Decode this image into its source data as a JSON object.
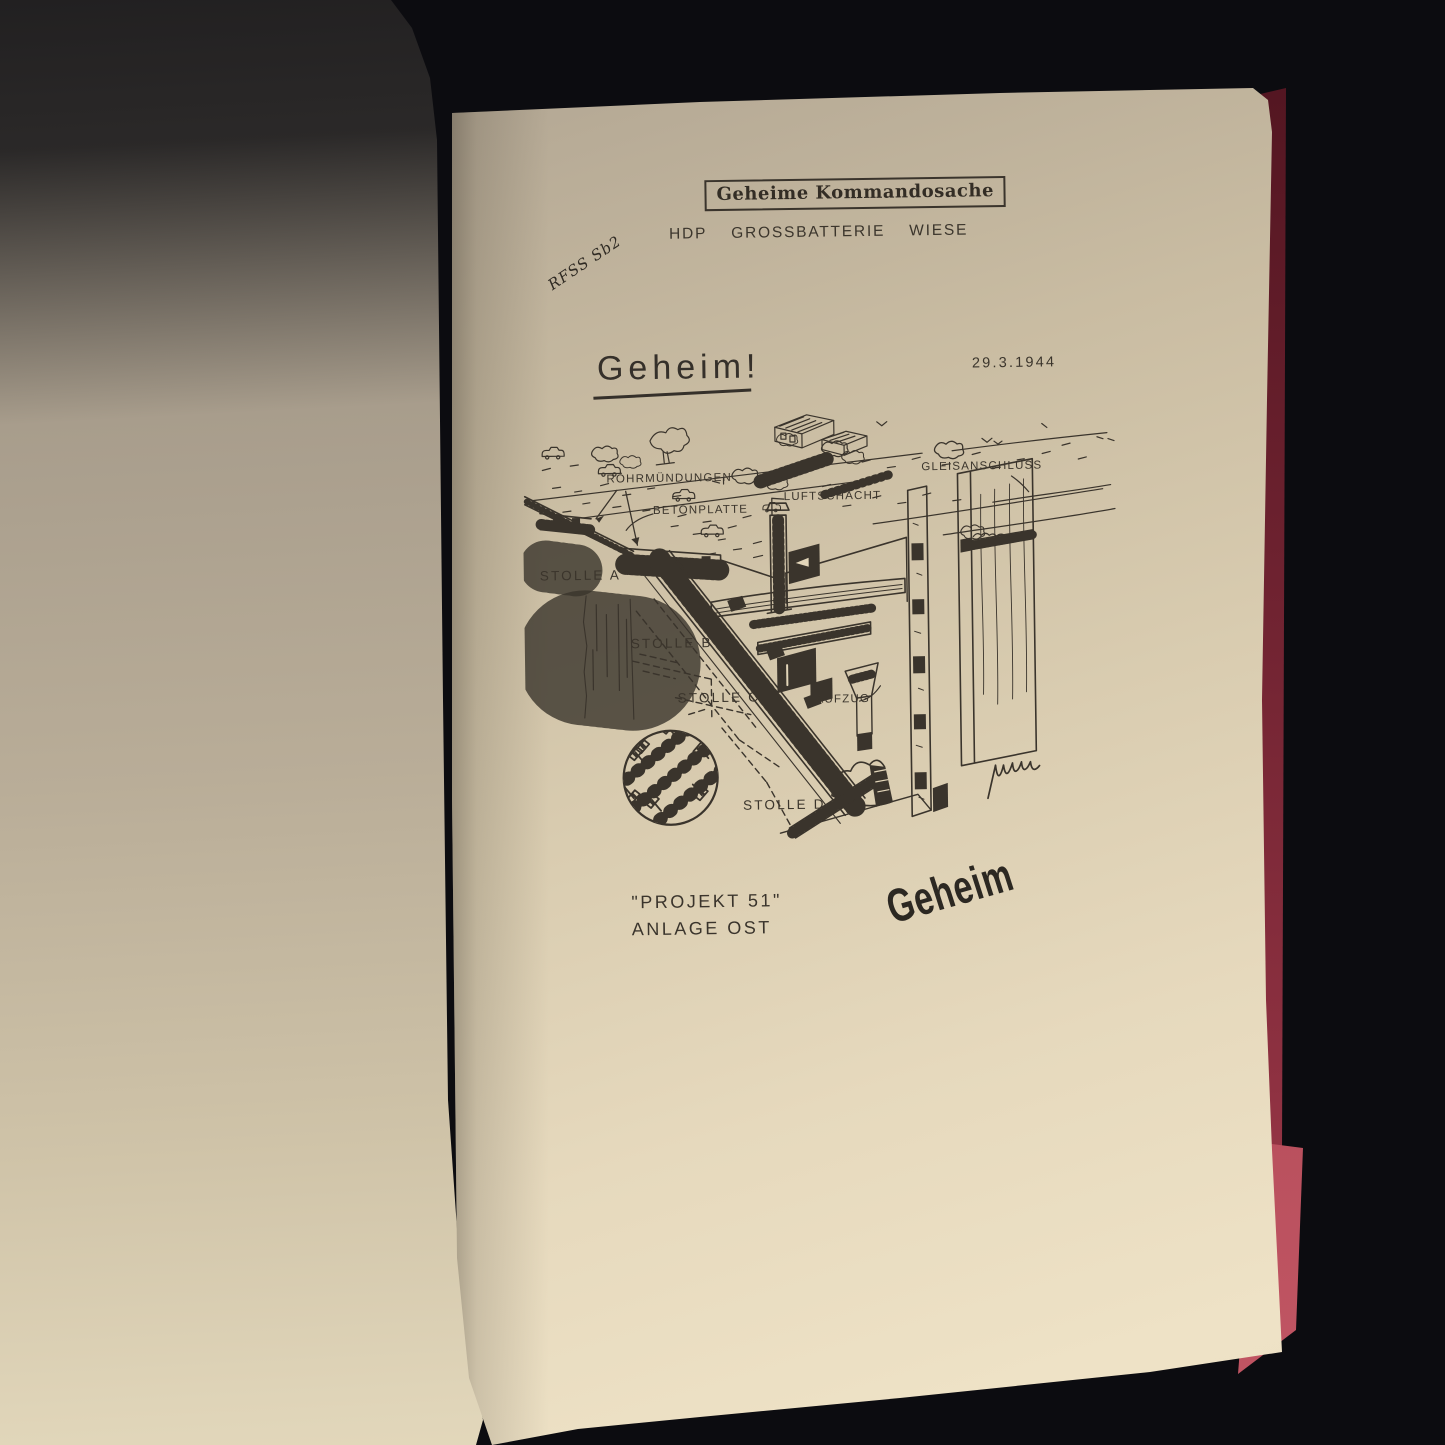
{
  "photo": {
    "background": "#0c0c10",
    "page_cream": "#e8dbbf",
    "left_page_tan": "#c9bca2",
    "cover_red": "#b04a57",
    "ink": "#3a342c"
  },
  "document": {
    "classification_box": "Geheime Kommandosache",
    "handwritten_note": "RFSS Sb2",
    "title": {
      "word1": "HDP",
      "word2": "GROSSBATTERIE",
      "word3": "WIESE"
    },
    "secret_heading": "Geheim!",
    "date": "29.3.1944",
    "diagram": {
      "labels": [
        {
          "id": "roehrmuendungen",
          "text": "RÖHRMÜNDUNGEN"
        },
        {
          "id": "betonplatte",
          "text": "BETONPLATTE"
        },
        {
          "id": "luftschacht",
          "text": "LUFTSCHACHT"
        },
        {
          "id": "gleisanschluss",
          "text": "GLEISANSCHLUSS"
        },
        {
          "id": "stolle-a",
          "text": "STOLLE A"
        },
        {
          "id": "stolle-b",
          "text": "STOLLE B"
        },
        {
          "id": "stolle-c",
          "text": "STOLLE C"
        },
        {
          "id": "aufzug",
          "text": "AUFZUG"
        },
        {
          "id": "stolle-d",
          "text": "STOLLE D"
        }
      ]
    },
    "caption": {
      "line1": "\"PROJEKT 51\"",
      "line2": "ANLAGE OST"
    },
    "diagonal_stamp": "Geheim"
  }
}
